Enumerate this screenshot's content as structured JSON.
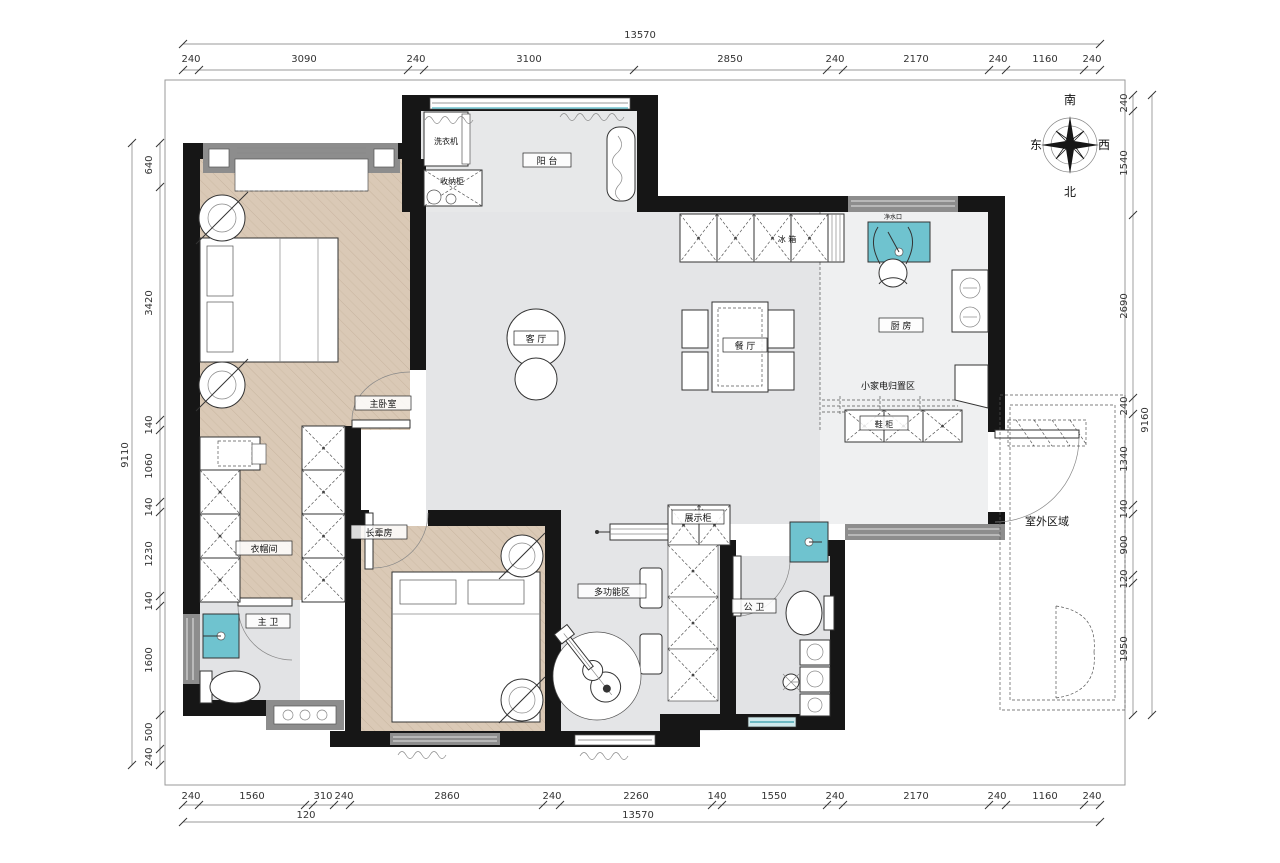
{
  "title": "apartment floor plan",
  "compass": {
    "south": "南",
    "east": "东",
    "west": "西",
    "north": "北"
  },
  "rooms": {
    "balcony": "阳 台",
    "living": "客 厅",
    "dining": "餐 厅",
    "kitchen": "厨 房",
    "fridge": "冰 箱",
    "washing_machine": "洗衣机",
    "storage_cabinet": "收纳柜",
    "water_point": "净水口",
    "small_appliance_area": "小家电归置区",
    "shoe_cabinet": "鞋 柜",
    "master_bedroom": "主卧室",
    "cloakroom": "衣帽间",
    "elder_room": "长辈房",
    "multi_function": "多功能区",
    "display_cabinet": "展示柜",
    "public_bath": "公 卫",
    "master_bath": "主 卫",
    "outdoor": "室外区域"
  },
  "dimensions": {
    "top": {
      "total": "13570",
      "segments": [
        "240",
        "3090",
        "240",
        "3100",
        "2850",
        "240",
        "2170",
        "240",
        "1160",
        "240"
      ]
    },
    "bottom": {
      "total": "13570",
      "extra": "120",
      "segments": [
        "240",
        "1560",
        "310",
        "240",
        "2860",
        "240",
        "2260",
        "140",
        "1550",
        "240",
        "2170",
        "240",
        "1160",
        "240"
      ]
    },
    "left": {
      "total": "9110",
      "segments": [
        "640",
        "3420",
        "140",
        "1060",
        "140",
        "1230",
        "140",
        "1600",
        "500",
        "240"
      ]
    },
    "right": {
      "total": "9160",
      "segments": [
        "240",
        "1540",
        "2690",
        "240",
        "1340",
        "140",
        "900",
        "120",
        "1950"
      ]
    }
  }
}
